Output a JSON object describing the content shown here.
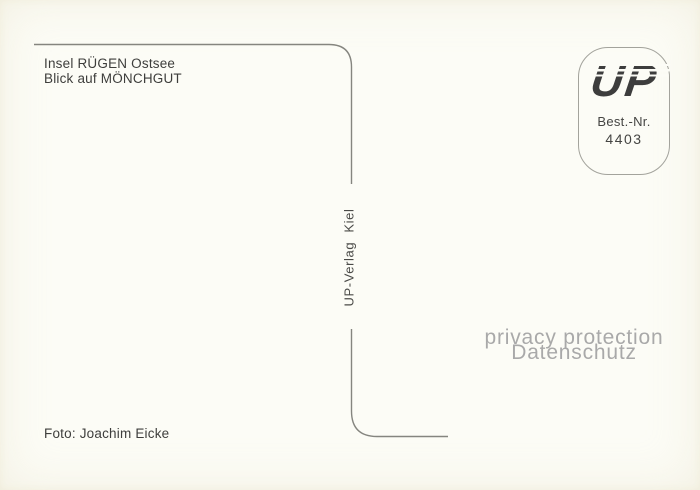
{
  "colors": {
    "background": "#fcfcf6",
    "divider_line": "#85857f",
    "body_text": "#3e3e3c",
    "watermark_text": "#a9a9a9",
    "logo_text": "#3d3d3d",
    "stamp_border": "#a3a39c"
  },
  "caption": {
    "line1": "Insel RÜGEN Ostsee",
    "line2": "Blick auf MÖNCHGUT"
  },
  "publisher": {
    "vertical_text": "UP-Verlag Kiel"
  },
  "stamp_box": {
    "logo": "UP",
    "order_label": "Best.-Nr.",
    "order_number": "4403"
  },
  "watermark": {
    "line1": "privacy protection",
    "line2": "Datenschutz"
  },
  "credit": {
    "text": "Foto: Joachim Eicke"
  }
}
